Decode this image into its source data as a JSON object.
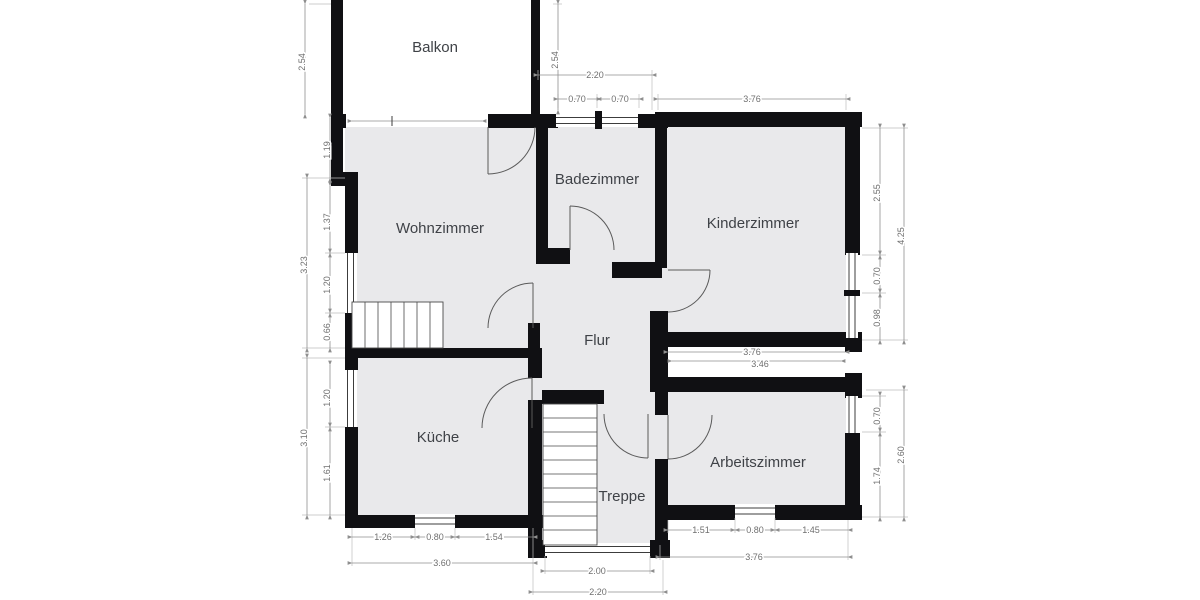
{
  "plan": {
    "type": "floorplan",
    "colors": {
      "wall": "#101013",
      "room_fill": "#e9e9eb",
      "dimension_line": "#8f8f8f",
      "dimension_text": "#6f6f6f",
      "label_text": "#3f4247",
      "background": "#ffffff"
    },
    "rooms": {
      "balkon": "Balkon",
      "wohnzimmer": "Wohnzimmer",
      "badezimmer": "Badezimmer",
      "kinderzimmer": "Kinderzimmer",
      "flur": "Flur",
      "kueche": "Küche",
      "treppe": "Treppe",
      "arbeitszimmer": "Arbeitszimmer"
    },
    "dims": {
      "balkon_left": "2.54",
      "balkon_right": "2.54",
      "left_seg1": "1.19",
      "left_seg2": "1.37",
      "left_window": "1.20",
      "left_seg3": "0.66",
      "left_total": "3.23",
      "left_lower_window": "1.20",
      "left_lower_seg": "1.61",
      "left_lower_total": "3.10",
      "bad_top_width": "2.20",
      "bad_window1": "0.70",
      "bad_window2": "0.70",
      "kinder_top_width": "3.76",
      "kinder_right_seg": "2.55",
      "kinder_right_win1": "0.70",
      "kinder_right_win2": "0.98",
      "kinder_right_total": "4.25",
      "arbeits_right_win": "0.70",
      "arbeits_right_seg": "1.74",
      "arbeits_right_total": "2.60",
      "mid_gap_upper": "3.76",
      "mid_gap_lower": "3.46",
      "kueche_bottom_seg1": "1.26",
      "kueche_bottom_win": "0.80",
      "kueche_bottom_seg2": "1.54",
      "kueche_bottom_total": "3.60",
      "treppe_bottom_inner": "2.00",
      "treppe_bottom_total": "2.20",
      "arbeits_bottom_seg1": "1.51",
      "arbeits_bottom_win": "0.80",
      "arbeits_bottom_seg2": "1.45",
      "arbeits_bottom_total": "3.76"
    }
  }
}
